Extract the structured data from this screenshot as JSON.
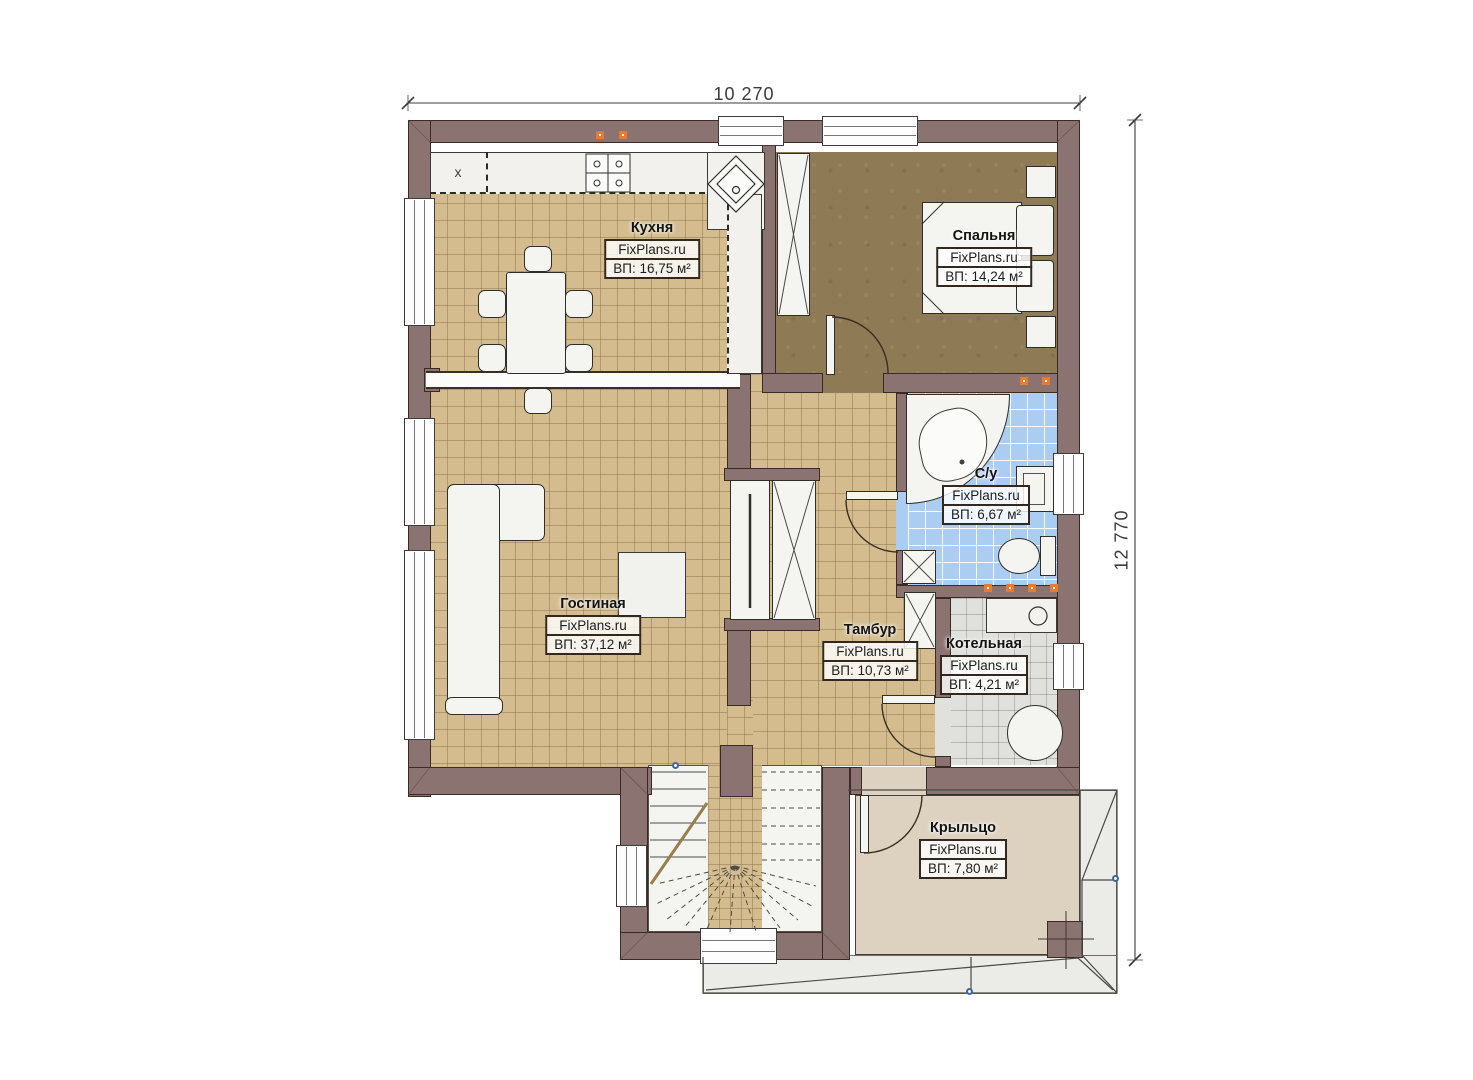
{
  "dimensions": {
    "width_label": "10 270",
    "height_label": "12 770"
  },
  "watermark": "FixPlans.ru",
  "rooms": [
    {
      "id": "kitchen",
      "name": "Кухня",
      "area_label": "ВП: 16,75 м²"
    },
    {
      "id": "bedroom",
      "name": "Спальня",
      "area_label": "ВП: 14,24 м²"
    },
    {
      "id": "bathroom",
      "name": "С/у",
      "area_label": "ВП: 6,67 м²"
    },
    {
      "id": "living_room",
      "name": "Гостиная",
      "area_label": "ВП: 37,12 м²"
    },
    {
      "id": "vestibule",
      "name": "Тамбур",
      "area_label": "ВП: 10,73 м²"
    },
    {
      "id": "boiler_room",
      "name": "Котельная",
      "area_label": "ВП: 4,21 м²"
    },
    {
      "id": "porch",
      "name": "Крыльцо",
      "area_label": "ВП: 7,80 м²"
    }
  ],
  "annotations": {
    "counter_x_marker": "x"
  },
  "colors": {
    "wall": "#8b7371",
    "floor_tile_tan": "#d4bc8f",
    "floor_bedroom": "#8e7a54",
    "floor_bathroom": "#accdf2",
    "floor_boiler": "#e0e0dd",
    "floor_porch": "#ddd2c0",
    "socket_marker": "#e87b2e",
    "survey_marker_blue": "#3f66a0"
  }
}
